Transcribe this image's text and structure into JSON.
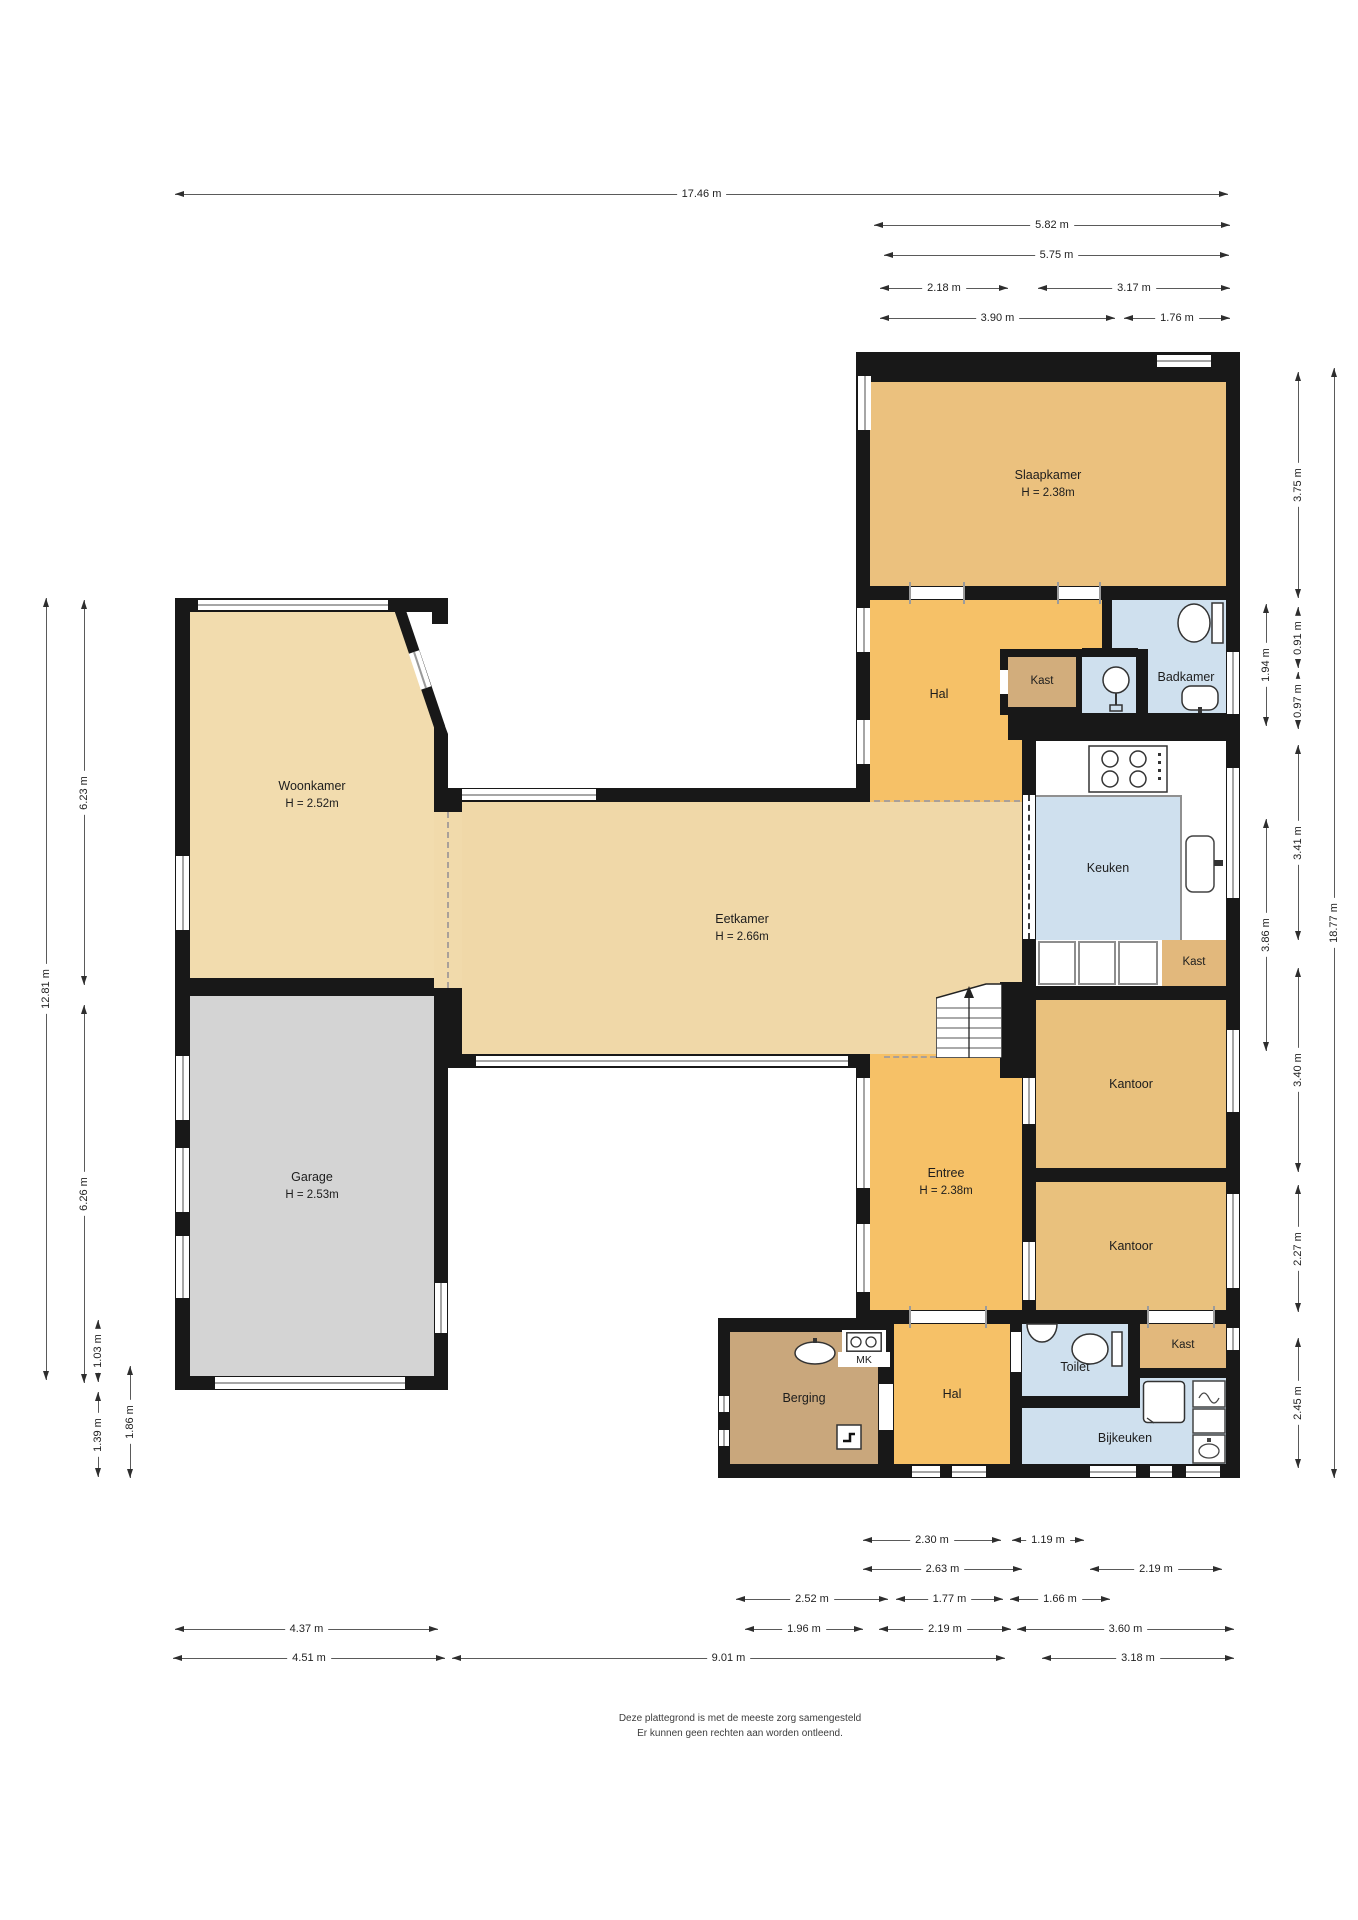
{
  "meta": {
    "type": "floorplan",
    "language": "nl"
  },
  "rooms": {
    "slaapkamer": {
      "name": "Slaapkamer",
      "height": "H = 2.38m"
    },
    "hal_boven": {
      "name": "Hal"
    },
    "kast_badkamer": {
      "name": "Kast"
    },
    "badkamer": {
      "name": "Badkamer"
    },
    "keuken": {
      "name": "Keuken"
    },
    "kast_keuken": {
      "name": "Kast"
    },
    "kantoor_boven": {
      "name": "Kantoor"
    },
    "kantoor_onder": {
      "name": "Kantoor"
    },
    "woonkamer": {
      "name": "Woonkamer",
      "height": "H = 2.52m"
    },
    "eetkamer": {
      "name": "Eetkamer",
      "height": "H = 2.66m"
    },
    "garage": {
      "name": "Garage",
      "height": "H = 2.53m"
    },
    "entree": {
      "name": "Entree",
      "height": "H = 2.38m"
    },
    "berging": {
      "name": "Berging"
    },
    "mk": {
      "name": "MK"
    },
    "hal_beneden": {
      "name": "Hal"
    },
    "toilet": {
      "name": "Toilet"
    },
    "kast_beneden": {
      "name": "Kast"
    },
    "bijkeuken": {
      "name": "Bijkeuken"
    }
  },
  "dims": {
    "top": [
      "17.46 m",
      "5.82 m",
      "5.75 m",
      "2.18 m",
      "3.17 m",
      "3.90 m",
      "1.76 m"
    ],
    "bottom": [
      "2.30 m",
      "1.19 m",
      "2.63 m",
      "2.19 m",
      "2.52 m",
      "1.77 m",
      "1.66 m",
      "4.37 m",
      "1.96 m",
      "2.19 m",
      "3.60 m",
      "4.51 m",
      "9.01 m",
      "3.18 m"
    ],
    "left": [
      "12.81 m",
      "6.23 m",
      "6.26 m",
      "1.03 m",
      "1.39 m",
      "1.86 m"
    ],
    "right": [
      "18.77 m",
      "3.75 m",
      "1.94 m",
      "0.91 m",
      "0.97 m",
      "3.41 m",
      "3.86 m",
      "3.40 m",
      "2.27 m",
      "2.45 m"
    ]
  },
  "footer": {
    "line1": "Deze plattegrond is met de meeste zorg samengesteld",
    "line2": "Er kunnen geen rechten aan worden ontleend."
  },
  "colors": {
    "wall": "#181818",
    "room_tan_light": "#f2dcae",
    "room_tan": "#f0d8a8",
    "room_dark_tan": "#e9c17d",
    "room_orange": "#f6c167",
    "room_brown": "#c9a77c",
    "room_kast": "#d2ad7c",
    "room_blue": "#cfe0ee",
    "room_gray": "#d4d4d4"
  },
  "icons": {
    "list": [
      "toilet-icon",
      "shower-icon",
      "sink-icon",
      "stove-icon",
      "washer-icon",
      "meter-box-icon",
      "stairs-up-icon",
      "tap-icon"
    ]
  }
}
